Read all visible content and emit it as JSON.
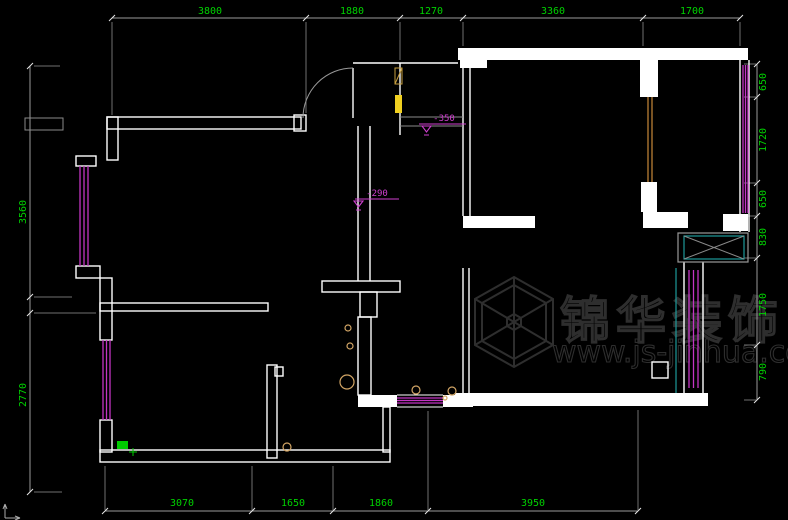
{
  "drawing": {
    "type": "floor-plan",
    "background": "#000000"
  },
  "dimensions": {
    "top": [
      "3800",
      "1880",
      "1270",
      "3360",
      "1700"
    ],
    "left": [
      "3560",
      "2770"
    ],
    "right": [
      "650",
      "1720",
      "650",
      "830",
      "1750",
      "790"
    ],
    "bottom": [
      "3070",
      "1650",
      "1860",
      "3950"
    ]
  },
  "level_marks": [
    "-350",
    "-290"
  ],
  "watermark": {
    "brand": "锦华装饰",
    "url": "www.js-jinhua.com"
  },
  "colors": {
    "dimension_text": "#00d200",
    "wall": "#ffffff",
    "window_magenta": "#c434c4",
    "level_magenta": "#d040d0",
    "panel_yellow": "#f0d020",
    "door_orange": "#c8883a",
    "teal": "#1d9a9a",
    "marker_green": "#00cc00",
    "watermark_gray": "#2e2e2e"
  }
}
